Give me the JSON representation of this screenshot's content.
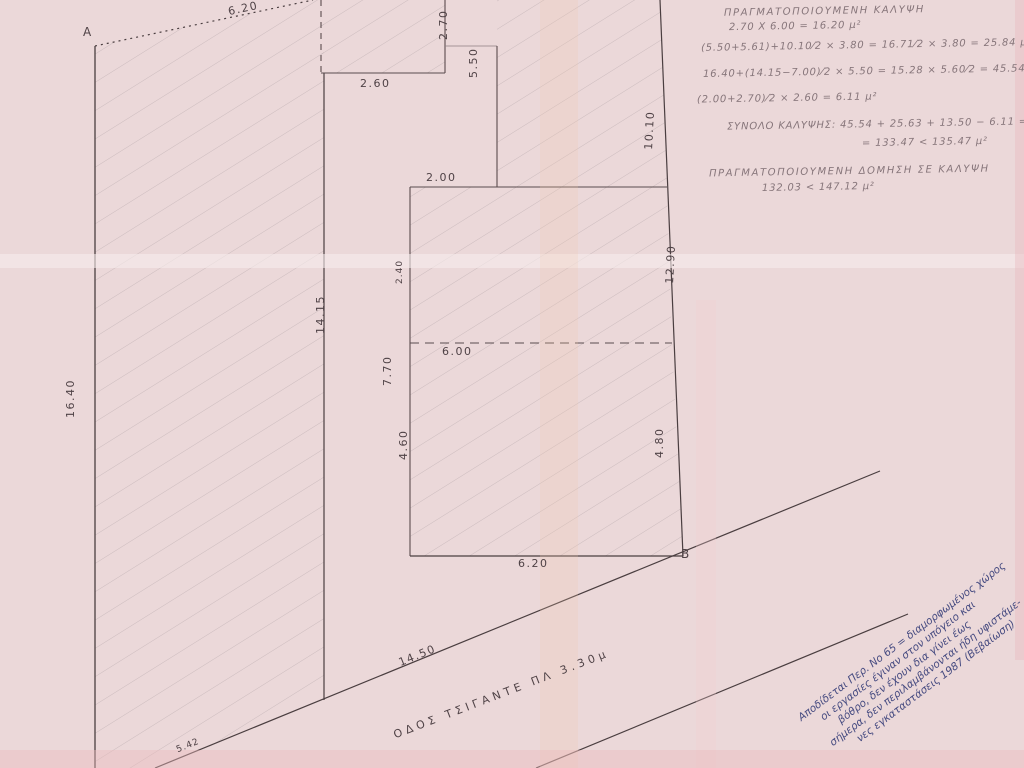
{
  "points": {
    "a": "Α",
    "b": "Β"
  },
  "dimensions": {
    "top_edge": "6.20",
    "notch_vertical": "2.70",
    "step_horizontal": "2.60",
    "upper_right_vertical": "5.50",
    "step2_horizontal": "2.00",
    "parallelogram_right": "14.15",
    "parallelogram_left": "16.40",
    "right_boundary_upper": "10.10",
    "right_boundary_lower": "12.90",
    "mid_small_vertical": "2.40",
    "mid_left_vertical": "7.70",
    "internal_dashed": "6.00",
    "lower_left_vertical": "4.60",
    "lower_right_vertical": "4.80",
    "bottom_edge": "6.20",
    "road_frontage": "14.50",
    "road_frontage_left": "5.42"
  },
  "road": {
    "label": "ΟΔΟΣ ΤΣΙΓΑΝΤΕ    ΠΛ 3.30μ"
  },
  "calculations": {
    "line1": "ΠΡΑΓΜΑΤΟΠΟΙΟΥΜΕΝΗ ΚΑΛΥΨΗ",
    "line2": "2.70 Χ 6.00 = 16.20 μ²",
    "line3": "(5.50+5.61)+10.10⁄2 × 3.80 = 16.71⁄2 × 3.80 = 25.84 μ²",
    "line4": "16.40+(14.15−7.00)⁄2 × 5.50 = 15.28 × 5.60⁄2 = 45.54 μ²",
    "line5": "(2.00+2.70)⁄2 × 2.60 = 6.11 μ²",
    "line6": "ΣΥΝΟΛΟ ΚΑΛΥΨΗΣ: 45.54 + 25.63 + 13.50 − 6.11 =",
    "line7": "= 133.47 < 135.47 μ²",
    "line8": "ΠΡΑΓΜΑΤΟΠΟΙΟΥΜΕΝΗ ΔΟΜΗΣΗ ΣΕ ΚΑΛΥΨΗ",
    "line9": "132.03 < 147.12 μ²"
  },
  "handwritten_note": {
    "line1": "Αποδίδεται Περ. Νο 65 = διαμορφωμένος χώρος",
    "line2": "οι εργασίες έγιναν στον υπόγειο και",
    "line3": "βόθρο, δεν έχουν δια γίνει έως",
    "line4": "σήμερα, δεν περιλαμβάνονται ήδη υφιστάμε-",
    "line5": "νες εγκαταστάσεις 1987 (Βεβαίωση)"
  },
  "colors": {
    "paper": "#ebd8d9",
    "ink": "#4f4246",
    "pencil": "#86757a",
    "note_ink": "#454a80",
    "hatch": "#b3a4a8"
  }
}
